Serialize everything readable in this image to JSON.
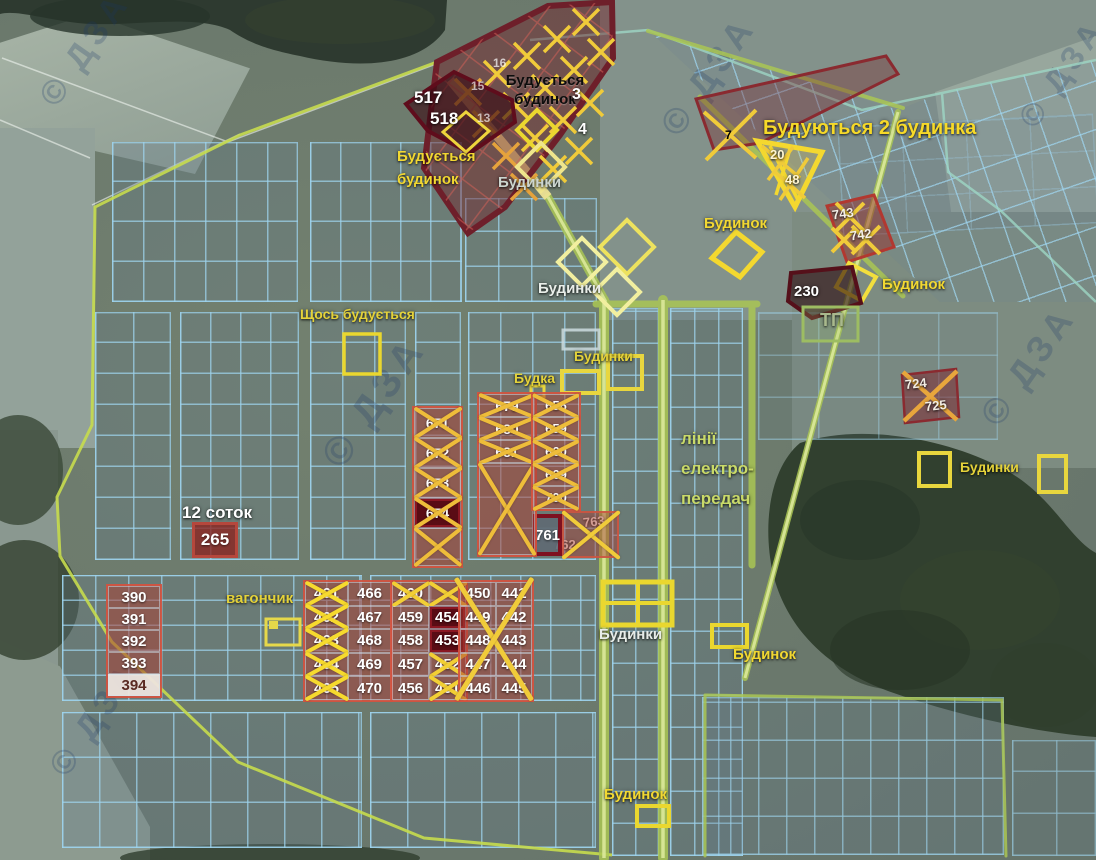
{
  "meta": {
    "watermark_text": "© ДЗА"
  },
  "colors": {
    "annotation_yellow": "#f2d832",
    "annotation_red": "#a03028",
    "grid_blue": "#9ed4ee",
    "boundary_green": "#c6dc4e",
    "cross_yellow": "#f0cb3a",
    "dark_plot_red": "#5a0c15"
  },
  "annotations": [
    {
      "kind": "text",
      "name": "label-buduetsya-budynok-black",
      "x": 497,
      "y": 72,
      "w": 96,
      "text": "Будується\nбудинок",
      "color": "#0d0d0d",
      "size": 15,
      "align": "center",
      "lh": 1.25,
      "shadow": "light"
    },
    {
      "kind": "text",
      "name": "label-517",
      "x": 414,
      "y": 88,
      "text": "517",
      "color": "#ffffff",
      "size": 17
    },
    {
      "kind": "text",
      "name": "label-518",
      "x": 430,
      "y": 109,
      "text": "518",
      "color": "#ffffff",
      "size": 17
    },
    {
      "kind": "text",
      "name": "label-buduetsya-budynok-yellow",
      "x": 397,
      "y": 146,
      "text": "Будується\nбудинок",
      "color": "#f2d832",
      "size": 15,
      "lh": 1.5
    },
    {
      "kind": "text",
      "name": "label-budynky-top",
      "x": 498,
      "y": 174,
      "text": "Будинки",
      "color": "#ccd5cf",
      "size": 15
    },
    {
      "kind": "text",
      "name": "label-plot-3",
      "x": 572,
      "y": 85,
      "text": "3",
      "color": "#ffffff",
      "size": 16
    },
    {
      "kind": "text",
      "name": "label-plot-4",
      "x": 578,
      "y": 120,
      "text": "4",
      "color": "#ffffff",
      "size": 16
    },
    {
      "kind": "text",
      "name": "label-plot-16",
      "x": 493,
      "y": 56,
      "text": "16",
      "color": "rgba(255,255,255,.7)",
      "size": 12,
      "shadow": "none"
    },
    {
      "kind": "text",
      "name": "label-plot-15",
      "x": 471,
      "y": 79,
      "text": "15",
      "color": "rgba(255,255,255,.65)",
      "size": 12,
      "shadow": "none"
    },
    {
      "kind": "text",
      "name": "label-plot-13",
      "x": 477,
      "y": 111,
      "text": "13",
      "color": "rgba(255,255,255,.65)",
      "size": 12,
      "shadow": "none"
    },
    {
      "kind": "text",
      "name": "label-buduyutsya-2-budynka",
      "x": 763,
      "y": 116,
      "text": "Будуються 2 будинка",
      "color": "#f6d929",
      "size": 20
    },
    {
      "kind": "text",
      "name": "label-plot-7",
      "x": 725,
      "y": 128,
      "text": "7",
      "color": "rgba(255,245,220,.85),",
      "size": 12,
      "shadow": "none"
    },
    {
      "kind": "text",
      "name": "label-plot-20",
      "x": 770,
      "y": 147,
      "text": "20",
      "color": "#fff6d0",
      "size": 13
    },
    {
      "kind": "text",
      "name": "label-plot-48",
      "x": 785,
      "y": 172,
      "text": "48",
      "color": "#fff6d0",
      "size": 13
    },
    {
      "kind": "text",
      "name": "label-budynok-ne",
      "x": 704,
      "y": 215,
      "text": "Будинок",
      "color": "#f2d832",
      "size": 15
    },
    {
      "kind": "text",
      "name": "label-plot-743",
      "x": 832,
      "y": 206,
      "text": "743",
      "color": "#f5f0e8",
      "size": 13,
      "rotate": -8
    },
    {
      "kind": "text",
      "name": "label-plot-742",
      "x": 850,
      "y": 227,
      "text": "742",
      "color": "#f5f0e8",
      "size": 13,
      "rotate": -8
    },
    {
      "kind": "text",
      "name": "label-plot-230",
      "x": 794,
      "y": 283,
      "text": "230",
      "color": "#ffffff",
      "size": 15
    },
    {
      "kind": "text",
      "name": "label-budynok-ne2",
      "x": 882,
      "y": 276,
      "text": "Будинок",
      "color": "#f2d832",
      "size": 15
    },
    {
      "kind": "text",
      "name": "label-tp",
      "x": 820,
      "y": 310,
      "text": "ТП",
      "color": "#a9b98d",
      "size": 18
    },
    {
      "kind": "text",
      "name": "label-shchos-buduetsya",
      "x": 300,
      "y": 306,
      "text": "Щось будується",
      "color": "#e4d23a",
      "size": 14
    },
    {
      "kind": "text",
      "name": "label-budynky-mid",
      "x": 574,
      "y": 348,
      "text": "Будинки",
      "color": "#e4d23a",
      "size": 14
    },
    {
      "kind": "text",
      "name": "label-budka",
      "x": 514,
      "y": 370,
      "text": "Будка",
      "color": "#e4d23a",
      "size": 14
    },
    {
      "kind": "text",
      "name": "label-power-lines",
      "x": 681,
      "y": 424,
      "text": "лінії\nелектро-\nпередач",
      "color": "#c9da69",
      "size": 17,
      "lh": 1.75
    },
    {
      "kind": "text",
      "name": "label-budynky-diamonds",
      "x": 538,
      "y": 280,
      "text": "Будинки",
      "color": "#e9eee9",
      "size": 15
    },
    {
      "kind": "text",
      "name": "label-plot-724",
      "x": 905,
      "y": 376,
      "text": "724",
      "color": "#f2ede4",
      "size": 13,
      "rotate": -6
    },
    {
      "kind": "text",
      "name": "label-plot-725",
      "x": 925,
      "y": 398,
      "text": "725",
      "color": "#f2ede4",
      "size": 13,
      "rotate": -6
    },
    {
      "kind": "text",
      "name": "label-budynky-right",
      "x": 960,
      "y": 459,
      "text": "Будинки",
      "color": "#e4d23a",
      "size": 14
    },
    {
      "kind": "text",
      "name": "label-12-sotok",
      "x": 182,
      "y": 503,
      "text": "12 соток",
      "color": "#ffffff",
      "size": 17
    },
    {
      "kind": "text",
      "name": "label-vagonchyk",
      "x": 226,
      "y": 590,
      "text": "вагончик",
      "color": "#e4d23a",
      "size": 15
    },
    {
      "kind": "text",
      "name": "label-budynky-bottom",
      "x": 599,
      "y": 626,
      "text": "Будинки",
      "color": "#e7ece8",
      "size": 15
    },
    {
      "kind": "text",
      "name": "label-budynok-mid",
      "x": 733,
      "y": 646,
      "text": "Будинок",
      "color": "#f2d832",
      "size": 15
    },
    {
      "kind": "text",
      "name": "label-budynok-bottom",
      "x": 604,
      "y": 786,
      "text": "Будинок",
      "color": "#f2d832",
      "size": 15
    },
    {
      "kind": "text",
      "name": "label-plot-763",
      "x": 583,
      "y": 514,
      "text": "763",
      "color": "#f2ede4",
      "size": 13,
      "rotate": -6
    },
    {
      "kind": "text",
      "name": "label-plot-762",
      "x": 554,
      "y": 537,
      "text": "762",
      "color": "#f2ede4",
      "size": 13
    },
    {
      "kind": "plate",
      "name": "plot-265",
      "x": 192,
      "y": 522,
      "w": 46,
      "h": 36,
      "text": "265",
      "bg": "rgba(140,35,30,.78)",
      "border": "3px solid #b5473c",
      "color": "#fff",
      "size": 17
    },
    {
      "kind": "plate",
      "name": "plot-761",
      "x": 533,
      "y": 514,
      "w": 29,
      "h": 42,
      "text": "761",
      "bg": "rgba(95,105,115,.92)",
      "border": "4px solid #7e1020",
      "color": "#fff",
      "size": 15
    },
    {
      "kind": "plate",
      "name": "box-762-763",
      "x": 562,
      "y": 511,
      "w": 57,
      "h": 47,
      "text": "",
      "bg": "rgba(170,60,50,.45)",
      "border": "2px solid rgba(205,85,65,.9)",
      "color": "#fff",
      "size": 12
    },
    {
      "kind": "cells",
      "name": "plots-390-394",
      "x": 106,
      "y": 584,
      "cols": 1,
      "cellW": 52,
      "cellH": 22,
      "fs": 15,
      "values": [
        {
          "t": "390"
        },
        {
          "t": "391"
        },
        {
          "t": "392"
        },
        {
          "t": "393"
        },
        {
          "t": "394",
          "light": true
        }
      ]
    },
    {
      "kind": "cells",
      "name": "plots-461-470",
      "x": 303,
      "y": 580,
      "cols": 2,
      "cellW": 43,
      "cellH": 23.6,
      "fs": 15,
      "xc": "#f6da2e",
      "xt": 4,
      "values": [
        {
          "t": "461",
          "x": true
        },
        {
          "t": "466"
        },
        {
          "t": "462",
          "x": true
        },
        {
          "t": "467"
        },
        {
          "t": "463",
          "x": true
        },
        {
          "t": "468"
        },
        {
          "t": "464",
          "x": true
        },
        {
          "t": "469"
        },
        {
          "t": "465",
          "x": true
        },
        {
          "t": "470"
        }
      ]
    },
    {
      "kind": "cells",
      "name": "plots-451-460",
      "x": 390,
      "y": 580,
      "cols": 2,
      "cellW": 37,
      "cellH": 23.6,
      "fs": 15,
      "xc": "#f2cf35",
      "xt": 3.5,
      "values": [
        {
          "t": "460",
          "x": true
        },
        {
          "t": "",
          "x": true
        },
        {
          "t": "459"
        },
        {
          "t": "454",
          "dark": true
        },
        {
          "t": "458"
        },
        {
          "t": "453",
          "dark": true
        },
        {
          "t": "457"
        },
        {
          "t": "452",
          "x": true
        },
        {
          "t": "456"
        },
        {
          "t": "451",
          "x": true
        }
      ]
    },
    {
      "kind": "cells",
      "name": "plots-441-450",
      "x": 458,
      "y": 580,
      "cols": 2,
      "cellW": 36,
      "cellH": 23.6,
      "fs": 15,
      "values": [
        {
          "t": "450"
        },
        {
          "t": "441"
        },
        {
          "t": "449"
        },
        {
          "t": "442"
        },
        {
          "t": "448"
        },
        {
          "t": "443"
        },
        {
          "t": "447"
        },
        {
          "t": "444"
        },
        {
          "t": "446"
        },
        {
          "t": "445"
        }
      ]
    },
    {
      "kind": "cells",
      "name": "plots-671-674",
      "x": 412,
      "y": 406,
      "cols": 1,
      "cellW": 47,
      "cellH": 30,
      "fs": 14,
      "xc": "#eebd3a",
      "xt": 4,
      "values": [
        {
          "t": "671",
          "x": true
        },
        {
          "t": "672",
          "x": true
        },
        {
          "t": "673",
          "x": true
        },
        {
          "t": "674",
          "x": true,
          "dark": true
        },
        {
          "t": "",
          "x": true,
          "h": 38
        }
      ]
    },
    {
      "kind": "cells",
      "name": "plots-679-681",
      "x": 477,
      "y": 392,
      "cols": 1,
      "cellW": 56,
      "cellH": 23,
      "fs": 14,
      "xc": "#eebd3a",
      "xt": 4,
      "values": [
        {
          "t": "679",
          "x": true
        },
        {
          "t": "680",
          "x": true
        },
        {
          "t": "681",
          "x": true
        },
        {
          "t": "",
          "x": true,
          "h": 92
        }
      ]
    },
    {
      "kind": "cells",
      "name": "plots-656-700",
      "x": 531,
      "y": 392,
      "cols": 1,
      "cellW": 46,
      "cellH": 23,
      "fs": 13,
      "xc": "#eebd3a",
      "xt": 3.5,
      "values": [
        {
          "t": "656",
          "x": true
        },
        {
          "t": "659",
          "x": true
        },
        {
          "t": "660",
          "x": true
        },
        {
          "t": "669",
          "x": true
        },
        {
          "t": "700",
          "x": true
        }
      ]
    },
    {
      "kind": "bigx",
      "name": "x-over-441-450",
      "x": 456,
      "y": 578,
      "w": 76,
      "h": 122,
      "color": "#f0cb3a",
      "t": 4.5
    },
    {
      "kind": "bigx",
      "name": "x-over-762-763",
      "x": 562,
      "y": 511,
      "w": 57,
      "h": 47,
      "color": "#f0cb3a",
      "t": 4
    }
  ]
}
